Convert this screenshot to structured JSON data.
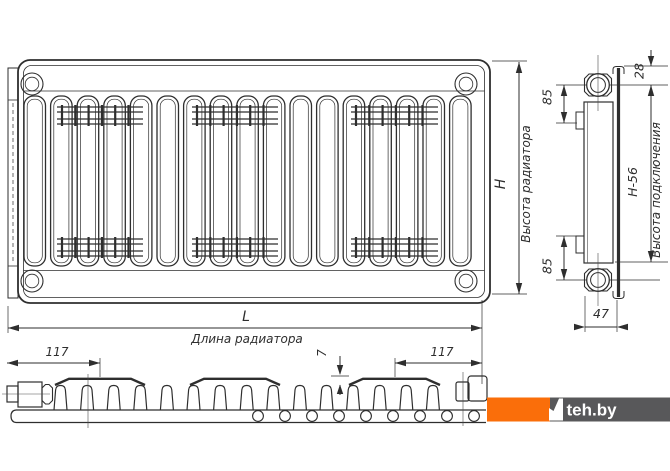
{
  "dimensions": {
    "height_letter": "H",
    "height_label": "Высота радиатора",
    "length_letter": "L",
    "length_label": "Длина радиатора",
    "top_offset": "28",
    "top_connection_spacing": "85",
    "bottom_connection_spacing": "85",
    "connection_height": "H-56",
    "connection_height_label": "Высота подключения",
    "depth": "47",
    "left_pitch": "117",
    "right_pitch": "117",
    "rib_height": "7"
  },
  "watermark": {
    "text": "teh.by"
  },
  "colors": {
    "line": "#2e2e2e",
    "watermark_orange": "#fa6e0a",
    "watermark_gray": "#58585a",
    "background": "#ffffff"
  }
}
